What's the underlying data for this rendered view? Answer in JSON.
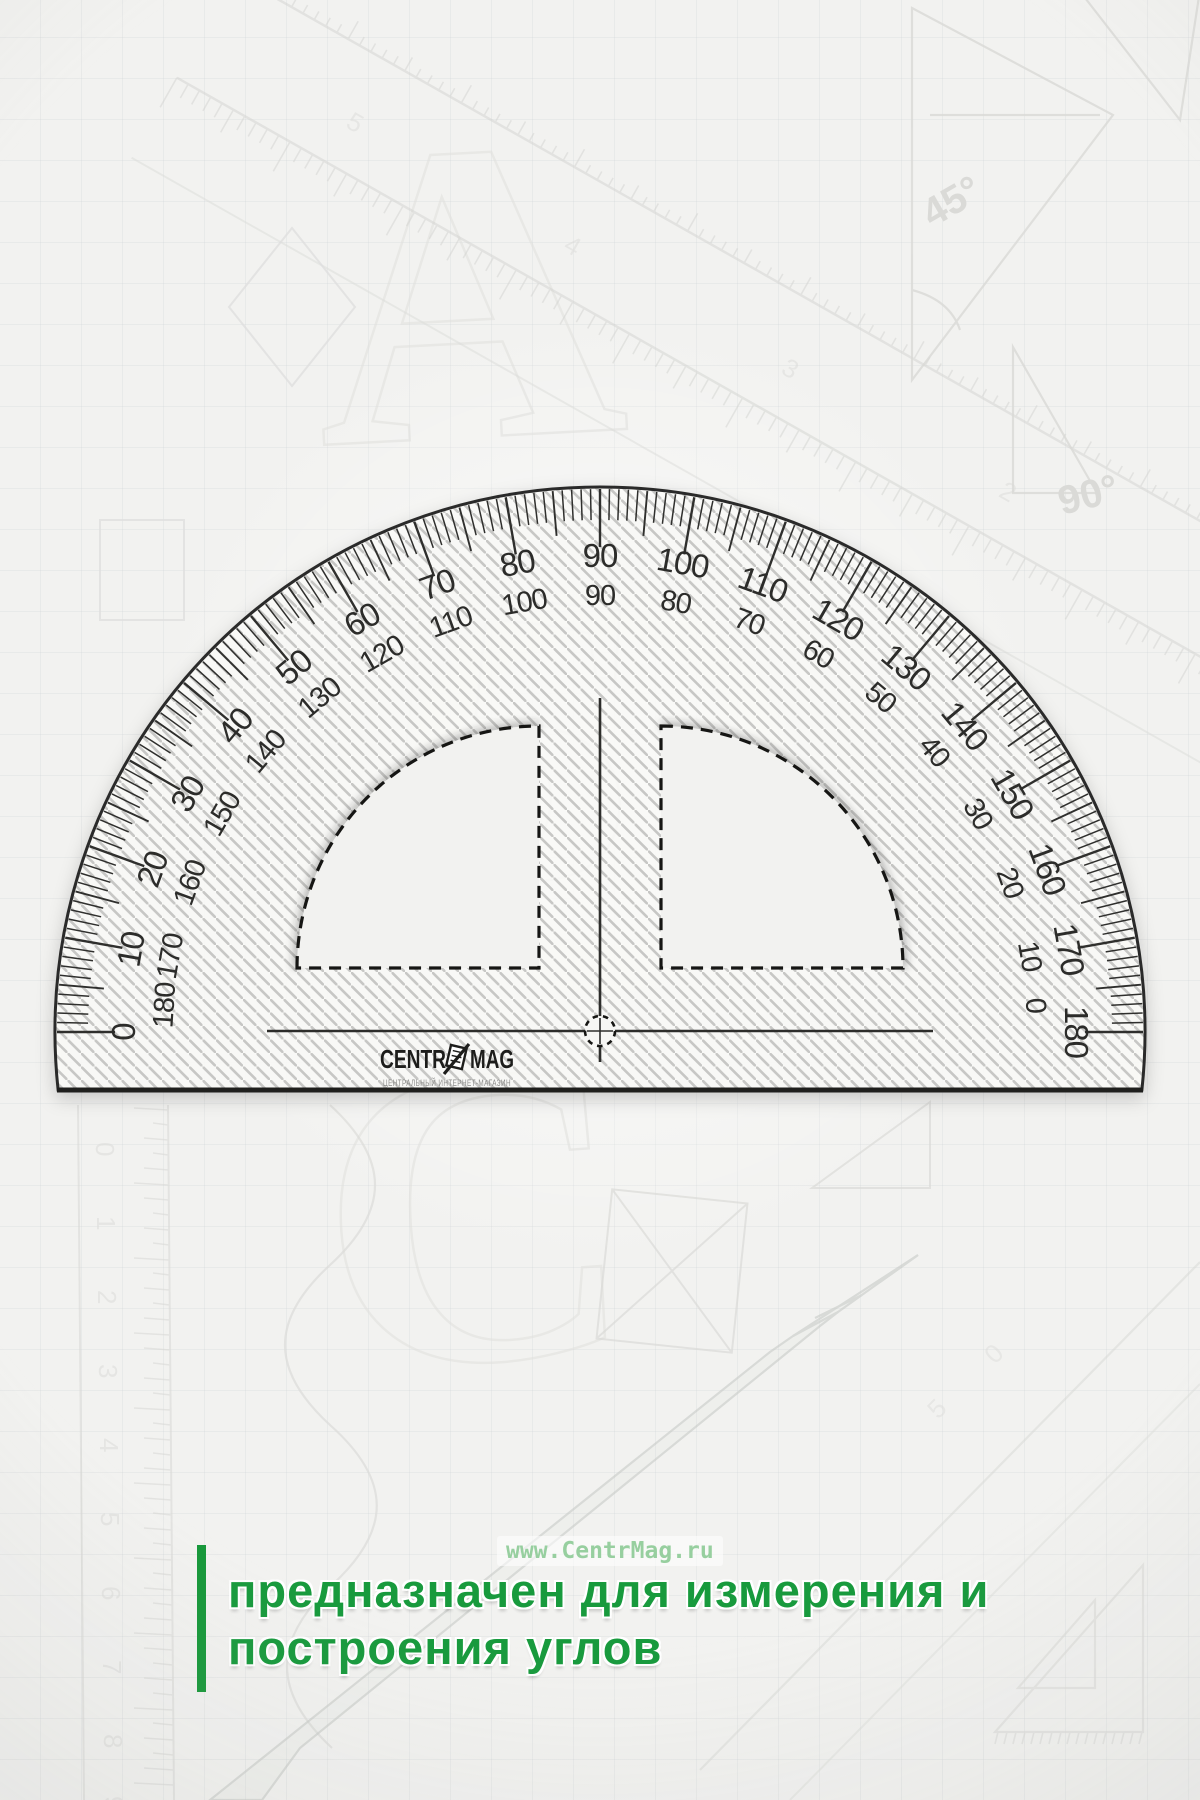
{
  "product": {
    "brand": {
      "name_left": "CENTR",
      "name_right": "MAG",
      "subtitle": "ЦЕНТРАЛЬНЫЙ ИНТЕРНЕТ-МАГАЗИН"
    },
    "scales": {
      "outer_labels": [
        "0",
        "10",
        "20",
        "30",
        "40",
        "50",
        "60",
        "70",
        "80",
        "90",
        "100",
        "110",
        "120",
        "130",
        "140",
        "150",
        "160",
        "170",
        "180"
      ],
      "inner_labels": [
        "180",
        "170",
        "160",
        "150",
        "140",
        "130",
        "120",
        "110",
        "100",
        "90",
        "80",
        "70",
        "60",
        "50",
        "40",
        "30",
        "20",
        "10",
        "0"
      ]
    }
  },
  "watermark": {
    "text": "www.CentrMag.ru",
    "color": "#97cf9f"
  },
  "caption": {
    "line1": "предназначен для измерения и",
    "line2": "построения углов",
    "accent_color": "#17983a"
  },
  "background_sketch": {
    "handwriting": [
      "90°",
      "45°"
    ],
    "letters": [
      "А",
      "Б",
      "С"
    ],
    "ruler_digits_vertical": [
      "0",
      "1",
      "2",
      "3",
      "4",
      "5",
      "6",
      "7",
      "8",
      "9"
    ],
    "ruler_digits_diagonal": [
      "1",
      "2",
      "3",
      "4",
      "5"
    ],
    "ruler_digits_diag2": [
      "5",
      "0"
    ]
  }
}
